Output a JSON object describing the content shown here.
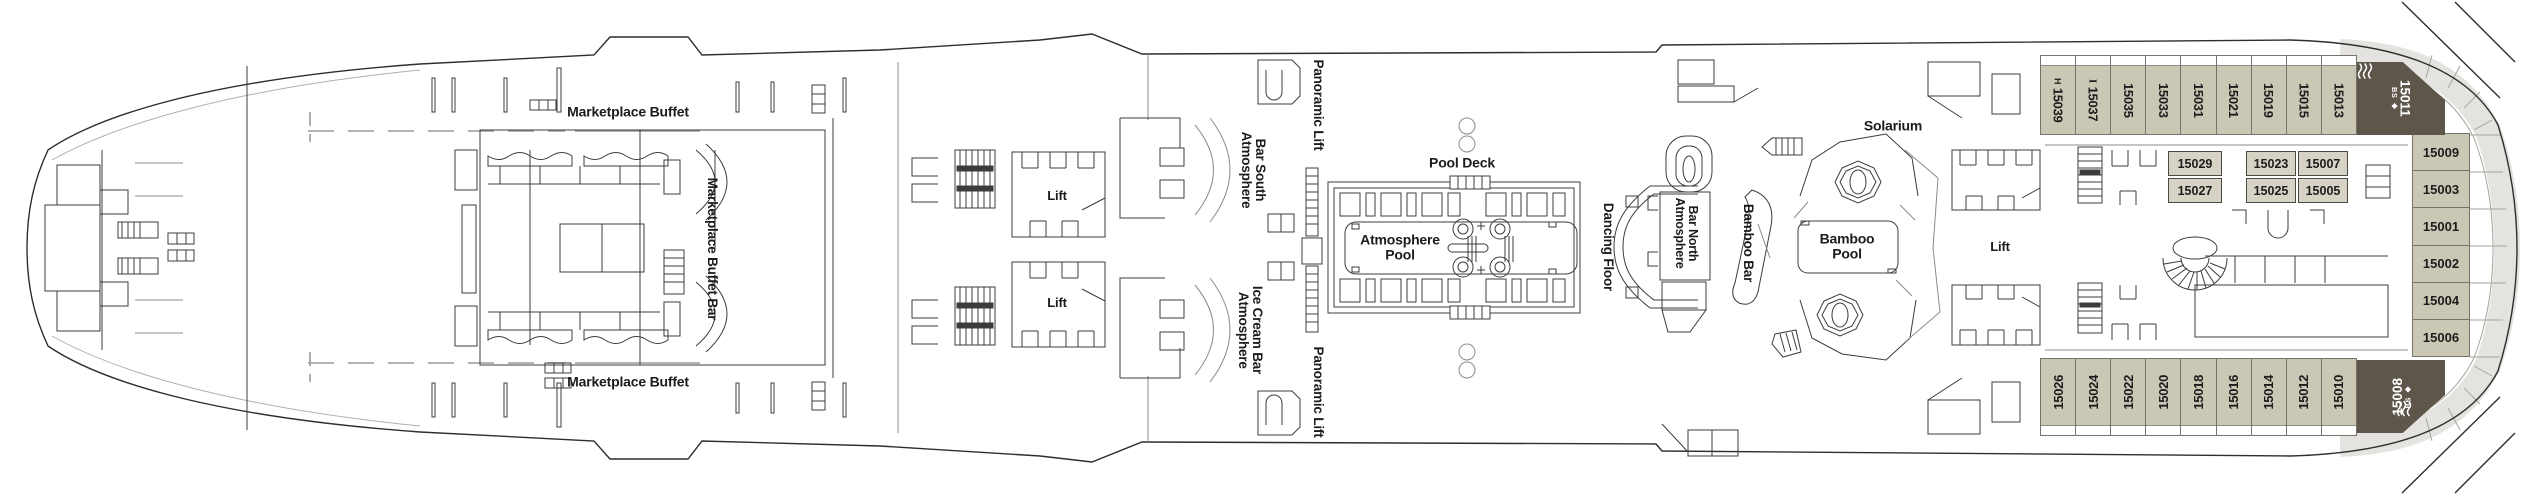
{
  "deck_plan": {
    "venues": {
      "marketplace_buffet_top": "Marketplace Buffet",
      "marketplace_buffet_bottom": "Marketplace Buffet",
      "marketplace_buffet_bar": "Marketplace Buffet Bar",
      "lift_forward_top": "Lift",
      "lift_forward_bottom": "Lift",
      "lift_aft": "Lift",
      "panoramic_lift_top": "Panoramic Lift",
      "panoramic_lift_bottom": "Panoramic Lift",
      "atmosphere_bar_south_line1": "Atmosphere",
      "atmosphere_bar_south_line2": "Bar South",
      "atmosphere_ice_cream_bar_line1": "Atmosphere",
      "atmosphere_ice_cream_bar_line2": "Ice Cream Bar",
      "pool_deck": "Pool Deck",
      "atmosphere_pool_line1": "Atmosphere",
      "atmosphere_pool_line2": "Pool",
      "dancing_floor": "Dancing Floor",
      "atmosphere_bar_north_line1": "Atmosphere",
      "atmosphere_bar_north_line2": "Bar North",
      "bamboo_bar": "Bamboo Bar",
      "bamboo_pool_line1": "Bamboo",
      "bamboo_pool_line2": "Pool",
      "solarium": "Solarium"
    },
    "cabins": {
      "top_row": [
        {
          "number": "15039",
          "icon": "H"
        },
        {
          "number": "15037",
          "icon": "I"
        },
        {
          "number": "15035"
        },
        {
          "number": "15033"
        },
        {
          "number": "15031"
        },
        {
          "number": "15021"
        },
        {
          "number": "15019"
        },
        {
          "number": "15015"
        },
        {
          "number": "15013"
        }
      ],
      "suite_top": {
        "number": "15011",
        "badge": "BS",
        "symbol": "◆"
      },
      "bottom_row": [
        "15026",
        "15024",
        "15022",
        "15020",
        "15018",
        "15016",
        "15014",
        "15012",
        "15010"
      ],
      "suite_bottom": {
        "number": "15008",
        "badge": "BS",
        "symbol": "◆"
      },
      "stern_column": [
        "15009",
        "15003",
        "15001",
        "15002",
        "15004",
        "15006"
      ],
      "interior_pair": [
        "15029",
        "15027"
      ],
      "interior_quad": [
        [
          "15023",
          "15007"
        ],
        [
          "15025",
          "15005"
        ]
      ]
    },
    "colors": {
      "cabin_fill": "#cbc7b5",
      "suite_fill": "#5e564b",
      "stern_band": "#e4e3df",
      "line": "#3c3c3c"
    }
  }
}
